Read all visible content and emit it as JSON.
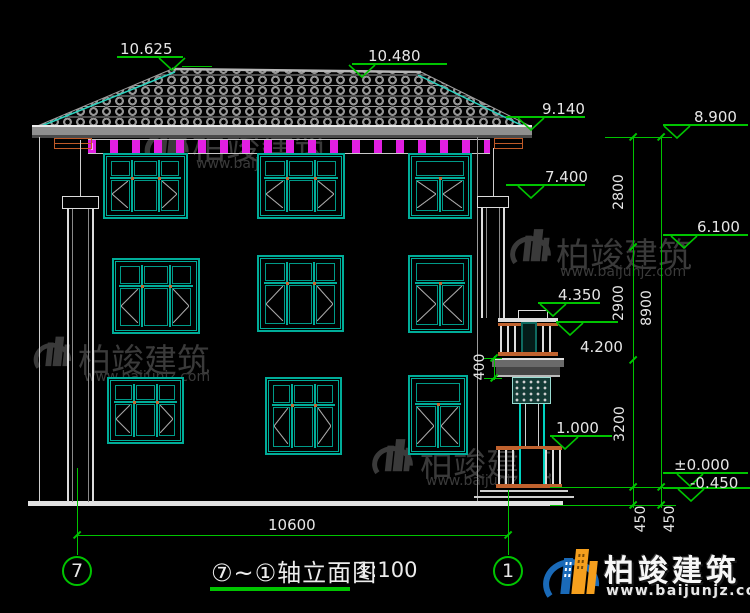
{
  "drawing": {
    "title": "⑦~①轴立面图",
    "scale": "1:100",
    "axis_left": "7",
    "axis_right": "1",
    "levels": [
      "10.625",
      "10.480",
      "9.140",
      "7.400",
      "8.900",
      "6.100",
      "4.350",
      "4.200",
      "1.000",
      "±0.000",
      "-0.450"
    ],
    "vertical_dims": [
      "2800",
      "2900",
      "3200",
      "8900",
      "450",
      "450",
      "400"
    ],
    "horizontal_dim": "10600",
    "colors": {
      "dim_green": "#00c400",
      "window_teal": "#00ad99",
      "dentil_magenta": "#e21fe2",
      "ornament_orange": "#c0622e",
      "line_white": "#cfcfcf",
      "tile_gray": "#969696",
      "watermark_gray": "#3a3a3a",
      "logo_blue": "#1a6ab8",
      "logo_orange": "#f59f1d"
    }
  },
  "watermark": {
    "brand": "柏竣建筑",
    "url": "www.baijunjz.com"
  },
  "footer": {
    "brand": "柏竣建筑",
    "url": "www.baijunjz.com"
  }
}
